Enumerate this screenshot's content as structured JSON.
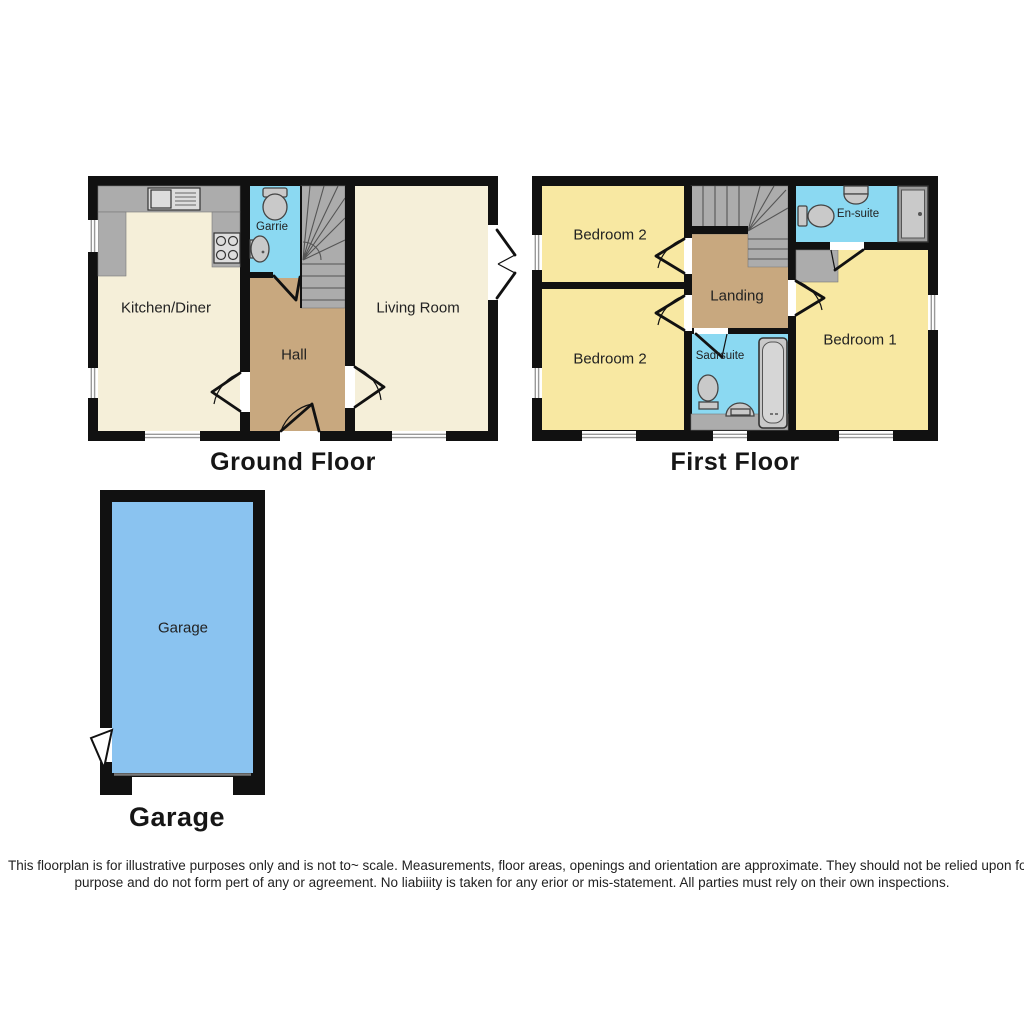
{
  "titles": {
    "ground_floor": "Ground Floor",
    "first_floor": "First Floor",
    "garage": "Garage"
  },
  "ground_floor": {
    "rooms": {
      "kitchen": "Kitchen/Diner",
      "hall": "Hall",
      "living_room": "Living Room",
      "cloakroom": "Garrie"
    }
  },
  "first_floor": {
    "rooms": {
      "bedroom2_top": "Bedroom 2",
      "bedroom2_bottom": "Bedroom 2",
      "landing": "Landing",
      "ensuite": "En-suite",
      "bathroom": "Sadrsuite",
      "bedroom1": "Bedroom 1"
    }
  },
  "garage": {
    "rooms": {
      "garage": "Garage"
    }
  },
  "disclaimer": {
    "line1": "This floorplan is for illustrative purposes only and is not to~ scale. Measurements, floor areas, openings and orientation are approximate. They should not be relied upon fo",
    "line2": "purpose and do not form pert of any or agreement. No liabiiity is taken for any erior or mis-statement. All parties must rely on their own inspections."
  },
  "colors": {
    "wall": "#111111",
    "cream": "#F5EFD9",
    "yellow": "#F8E8A2",
    "tan": "#C8A87F",
    "cyan": "#8BD9F2",
    "garage_blue": "#8AC3F0",
    "stairs_gray": "#ACACAC",
    "fixture_gray": "#C9C9C9",
    "window_line": "#999999",
    "text": "#1D1D1D"
  }
}
